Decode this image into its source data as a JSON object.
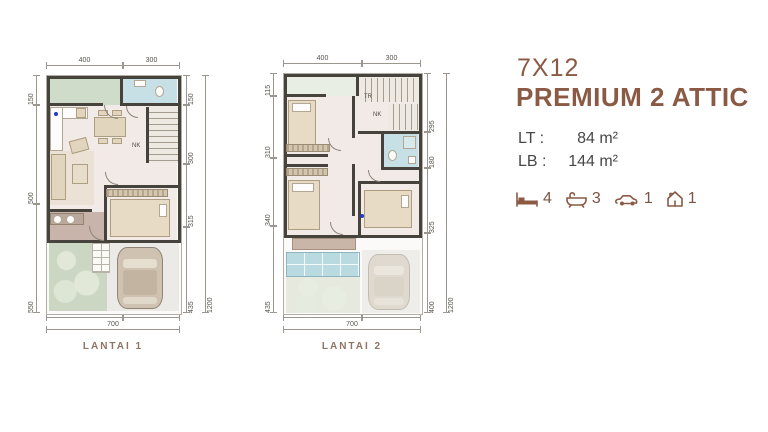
{
  "header": {
    "size": "7X12",
    "name": "PREMIUM 2 ATTIC"
  },
  "specs": {
    "lt_label": "LT :",
    "lt_value": "84 m²",
    "lb_label": "LB :",
    "lb_value": "144 m²"
  },
  "features": {
    "beds": "4",
    "baths": "3",
    "cars": "1",
    "attic": "1"
  },
  "colors": {
    "accent": "#8a5a45",
    "text": "#474747",
    "wall": "#46423c",
    "floor": "#f2eae6",
    "terrace": "#c9b4ab",
    "green_room": "#cfdcc9",
    "bathroom": "#c6e0e6",
    "garden": "#ccd7c3",
    "label": "#8f7466"
  },
  "plans": [
    {
      "label": "LANTAI 1",
      "stairs": "NK",
      "dims": {
        "top": [
          "400",
          "300"
        ],
        "left": [
          "150",
          "500",
          "550"
        ],
        "right": [
          "150",
          "300",
          "315",
          "435"
        ],
        "right_total": "1200",
        "bottom": [
          "400",
          "300"
        ],
        "bottom_total": "700"
      }
    },
    {
      "label": "LANTAI 2",
      "stairs_up": "TR",
      "stairs": "NK",
      "dims": {
        "top": [
          "400",
          "300"
        ],
        "left": [
          "115",
          "310",
          "340",
          "435"
        ],
        "right": [
          "295",
          "180",
          "325",
          "400"
        ],
        "right_total": "1200",
        "bottom": [
          "400",
          "300"
        ],
        "bottom_total": "700"
      }
    }
  ]
}
